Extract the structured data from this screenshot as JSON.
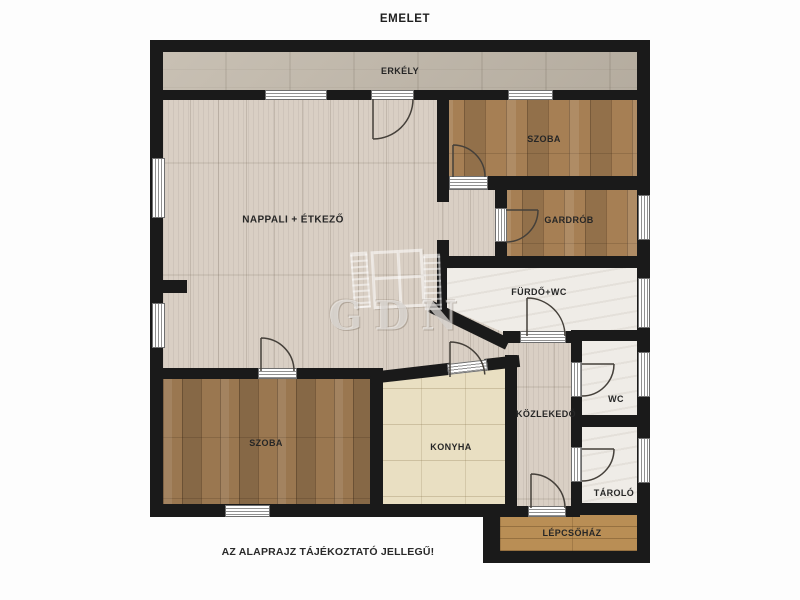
{
  "title": "EMELET",
  "disclaimer": "AZ ALAPRAJZ TÁJÉKOZTATÓ JELLEGŰ!",
  "watermark": {
    "text": "GDN",
    "logo": "window-with-shutters-logo"
  },
  "rooms": {
    "erkely": {
      "label": "ERKÉLY"
    },
    "nappali": {
      "label": "NAPPALI + ÉTKEZŐ"
    },
    "szoba_felso": {
      "label": "SZOBA"
    },
    "gardrob": {
      "label": "GARDRÓB"
    },
    "furdo": {
      "label": "FÜRDŐ+WC"
    },
    "wc": {
      "label": "WC"
    },
    "kozlekedo": {
      "label": "KÖZLEKEDŐ"
    },
    "tarolo": {
      "label": "TÁROLÓ"
    },
    "szoba_also": {
      "label": "SZOBA"
    },
    "konyha": {
      "label": "KONYHA"
    },
    "lepcsohaz": {
      "label": "LÉPCSŐHÁZ"
    }
  },
  "colors": {
    "bg": "#fdfdfd",
    "wall": "#1a1a1a",
    "floor_living": "#d9cfc4",
    "floor_balcony": "#c2b9ab",
    "floor_wood": "#a67f54",
    "floor_wood_dark": "#9a7750",
    "floor_kitchen": "#e9dfc2",
    "floor_tile": "#efece7",
    "floor_stairs": "#b98e55",
    "label": "#262626",
    "door": "#45403a",
    "watermark": "rgba(255,255,255,0.55)"
  }
}
